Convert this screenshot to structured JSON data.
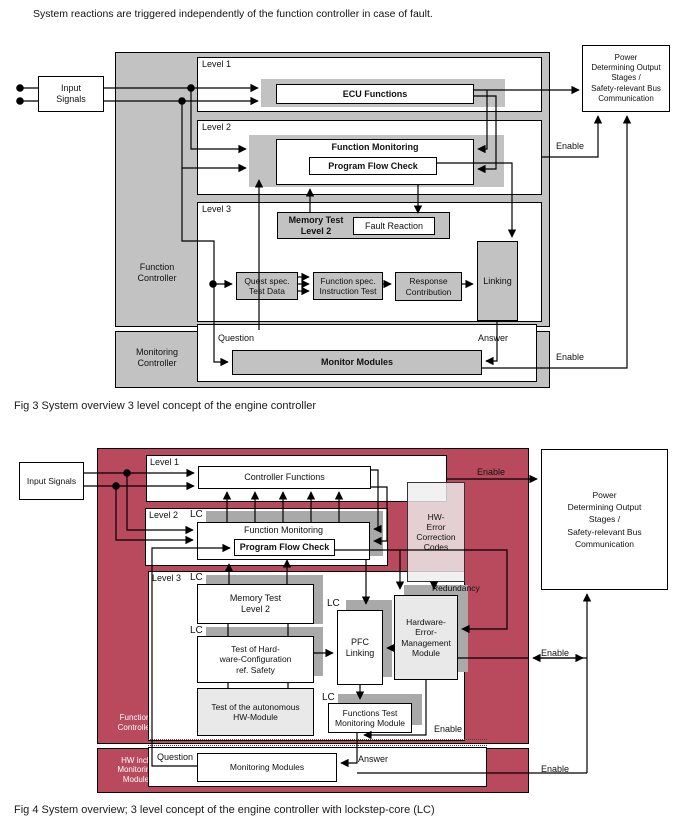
{
  "intro": "System reactions are triggered independently of the function controller in case of fault.",
  "colors": {
    "panel_gray": "#c2c2c2",
    "panel_red": "#b9495c",
    "shadow_gray": "#a9a9a9",
    "light_gray": "#e9e9e9"
  },
  "fig3": {
    "caption": "Fig 3 System overview 3 level concept of the engine controller",
    "input_signals": "Input\nSignals",
    "function_controller": "Function\nController",
    "monitoring_controller": "Monitoring\nController",
    "level1": "Level 1",
    "ecu_functions": "ECU Functions",
    "level2": "Level 2",
    "function_monitoring": "Function Monitoring",
    "program_flow_check": "Program Flow Check",
    "level3": "Level 3",
    "memory_test": "Memory Test\nLevel 2",
    "fault_reaction": "Fault Reaction",
    "quest_spec": "Quest spec.\nTest Data",
    "function_spec": "Function spec.\nInstruction Test",
    "response_contribution": "Response\nContribution",
    "linking": "Linking",
    "question": "Question",
    "answer": "Answer",
    "monitor_modules": "Monitor Modules",
    "power_output": "Power\nDetermining Output\nStages /\nSafety-relevant Bus\nCommunication",
    "enable": "Enable"
  },
  "fig4": {
    "caption": "Fig 4 System overview; 3 level concept of the engine controller with lockstep-core (LC)",
    "input_signals": "Input Signals",
    "function_controller": "Function\nController",
    "hw_incl_monitoring": "HW incl.\nMonitoring\nModule",
    "level1": "Level 1",
    "controller_functions": "Controller Functions",
    "level2": "Level 2",
    "lc": "LC",
    "function_monitoring": "Function Monitoring",
    "program_flow_check": "Program Flow Check",
    "level3": "Level 3",
    "memory_test": "Memory Test\nLevel 2",
    "test_hw_config": "Test of Hard-\nware-Configuration\nref. Safety",
    "test_autonomous": "Test of the autonomous\nHW-Module",
    "pfc_linking": "PFC\nLinking",
    "hw_error_mgmt": "Hardware-\nError-\nManagement\nModule",
    "hw_error_correction": "HW-\nError\nCorrection\nCodes",
    "redundancy": "Redundancy",
    "functions_test": "Functions Test\nMonitoring Module",
    "question": "Question",
    "answer": "Answer",
    "monitoring_modules": "Monitoring Modules",
    "power_output": "Power\nDetermining Output\nStages /\nSafety-relevant Bus\nCommunication",
    "enable": "Enable"
  }
}
